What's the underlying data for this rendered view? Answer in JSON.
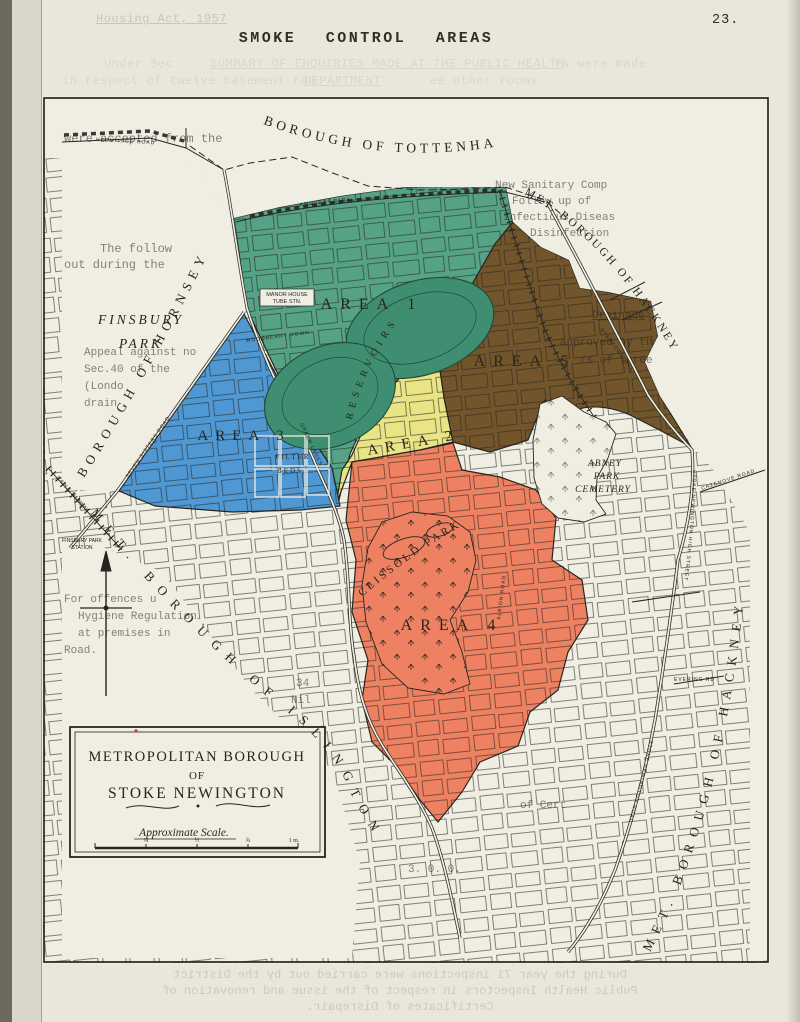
{
  "page": {
    "number": "23.",
    "title": "SMOKE CONTROL AREAS"
  },
  "colors": {
    "paper": "#e9e7da",
    "map_paper": "#f0eee3",
    "ink": "#26261f",
    "green": "#56a286",
    "green_dark": "#3f8e71",
    "blue": "#4f98d3",
    "yellow": "#e9e485",
    "orange": "#ee8162",
    "brown": "#72552b",
    "bleed": "#a3aeb1",
    "red_dot": "#c0392b"
  },
  "map": {
    "boroughs": {
      "tottenham": "BOROUGH OF TOTTENHAM",
      "hackney_top": "MET. BOROUGH OF HACKNEY",
      "hornsey": "BOROUGH OF HORNSEY",
      "islington": "MET. BOROUGH OF ISLINGTON",
      "hackney_right": "MET. BOROUGH OF HACKNEY"
    },
    "areas": {
      "area1": "AREA 1",
      "area2": "AREA 2",
      "area3": "AREA 3",
      "area4": "AREA 4",
      "area5": "AREA 5"
    },
    "places": {
      "finsbury_1": "FINSBURY",
      "finsbury_2": "PARK",
      "reservoirs": "RESERVOIRS",
      "filter_1": "FILTER",
      "filter_2": "BEDS",
      "clissold": "CLISSOLD PARK",
      "abney_1": "ABNEY",
      "abney_2": "PARK",
      "abney_3": "CEMETERY",
      "manor_1": "MANOR HOUSE",
      "manor_2": "TUBE STN.",
      "station_1": "FINSBURY PARK",
      "station_2": "STATION",
      "railway": "L.& N.E. RAILWAY"
    },
    "roads": [
      "SEVEN SISTERS ROAD",
      "GREEN LANES",
      "WOODBERRY DOWN",
      "AMHURST PARK",
      "STAMFORD HILL",
      "STOKE NEWINGTON HIGH STREET",
      "STOKE NEWINGTON ROAD",
      "EVERING RD",
      "CAZENOVE ROAD",
      "ALBION ROAD",
      "HERMITAGE ROAD"
    ],
    "legend": {
      "line1": "METROPOLITAN BOROUGH",
      "line2": "OF",
      "line3": "STOKE NEWINGTON",
      "scale_label": "Approximate Scale.",
      "ticks": [
        "¼",
        "½",
        "¾",
        "1 m."
      ]
    }
  },
  "bleedthrough": {
    "top1": "Housing Act, 1957",
    "top2a": "Under Sec",
    "top2b": "SUMMARY OF ENQUIRIES MADE AT THE PUBLIC HEALTH",
    "top2c": "rs were made",
    "top3a": "in respect of twelve basement roo",
    "top3b": "DEPARTMENT",
    "top3c": "ee other rooms.",
    "bottom1": "During the year 71 inspections were carried out by the District",
    "bottom2": "Public Health Inspectors in respect of the issue and renovation of",
    "bottom3": "Certificates of Disrepair.",
    "map_lines": [
      "were accepted from the",
      "New Sanitary Comp",
      "Follow up of",
      "Infectious Diseas",
      "Disinfection",
      "The follow",
      "out during the",
      "Drainage",
      "approved by th",
      "rs of three",
      "Appeal against no",
      "Sec.40 of the",
      "(Londo",
      "drain",
      "34",
      "Nil",
      "For offences u",
      "Hygiene Regulation",
      "at premises in",
      "Road.",
      "of Cert",
      "3. 0. 0."
    ]
  }
}
